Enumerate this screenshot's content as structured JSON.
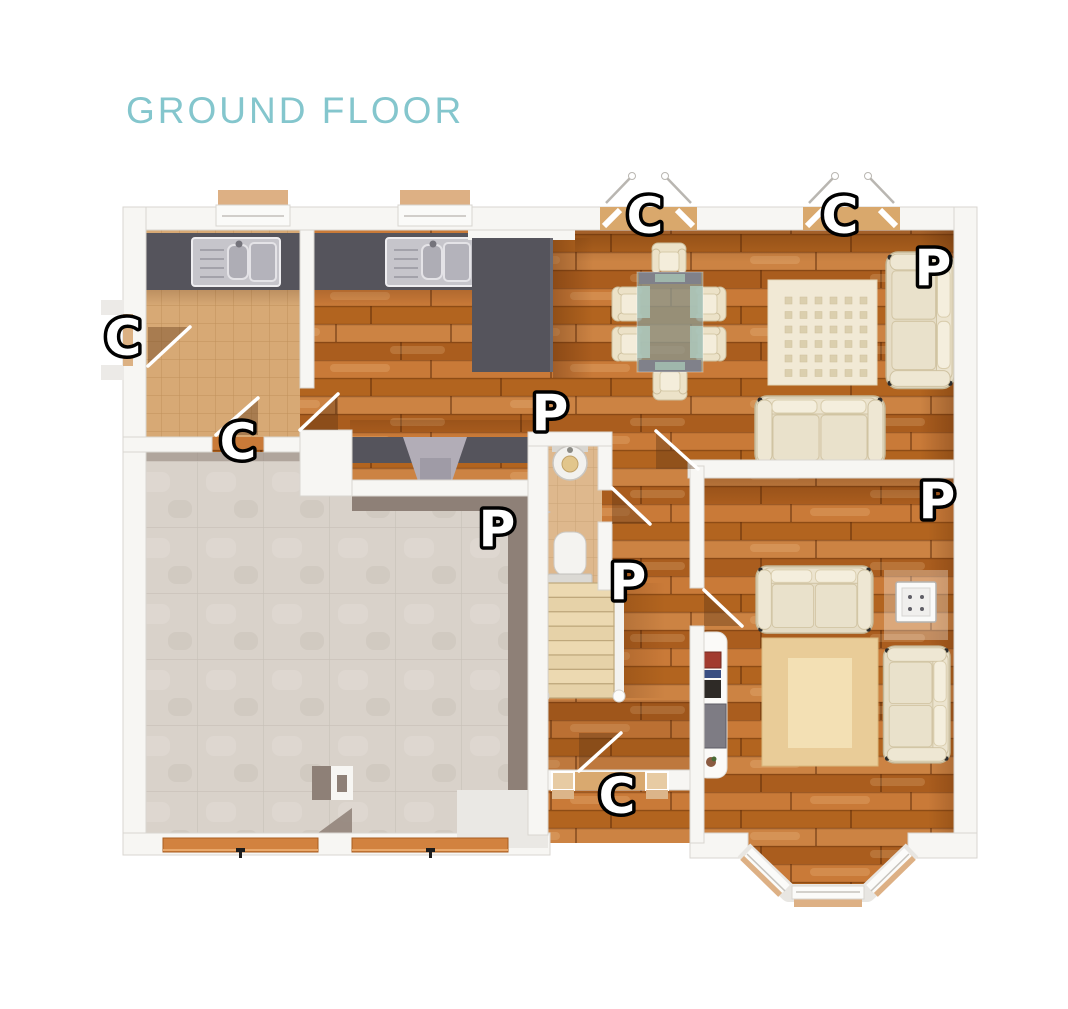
{
  "title": "GROUND FLOOR",
  "colors": {
    "title_teal": "#84c6cd",
    "marker_fill": "#ffffff",
    "marker_outline": "#000000",
    "wood_floor": "#c0722f",
    "tile_floor": "#d7a975",
    "garage_floor": "#d9d2ca",
    "counter_dark": "#55545c",
    "wall_white": "#f7f6f3",
    "wall_gray": "#e3e1dc",
    "sofa_cream": "#e5dcc5",
    "garage_door_orange": "#d2823f"
  },
  "labels": [
    {
      "letter": "C"
    },
    {
      "letter": "C"
    },
    {
      "letter": "P"
    },
    {
      "letter": "C"
    },
    {
      "letter": "C"
    },
    {
      "letter": "P"
    },
    {
      "letter": "P"
    },
    {
      "letter": "P"
    },
    {
      "letter": "P"
    },
    {
      "letter": "C"
    }
  ]
}
